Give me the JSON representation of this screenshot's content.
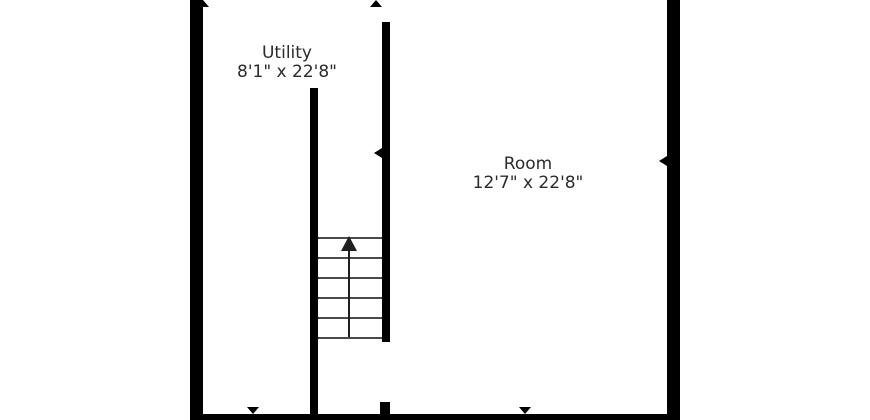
{
  "floorplan": {
    "rooms": {
      "utility": {
        "name": "Utility",
        "dimensions": "8'1\" x 22'8\""
      },
      "room": {
        "name": "Room",
        "dimensions": "12'7\" x 22'8\""
      }
    },
    "stairs": {
      "tread_count": 6,
      "tread_spacing_px": 20,
      "direction": "up"
    },
    "icons": {
      "stairs_direction": "up-arrow",
      "door_markers": [
        "top-left",
        "top-center",
        "stairs-wall",
        "right-wall",
        "bottom-utility",
        "bottom-room"
      ]
    },
    "colors": {
      "wall": "#000000",
      "tread": "#4a4a4a",
      "text": "#2b2b2b",
      "background": "#ffffff"
    }
  }
}
